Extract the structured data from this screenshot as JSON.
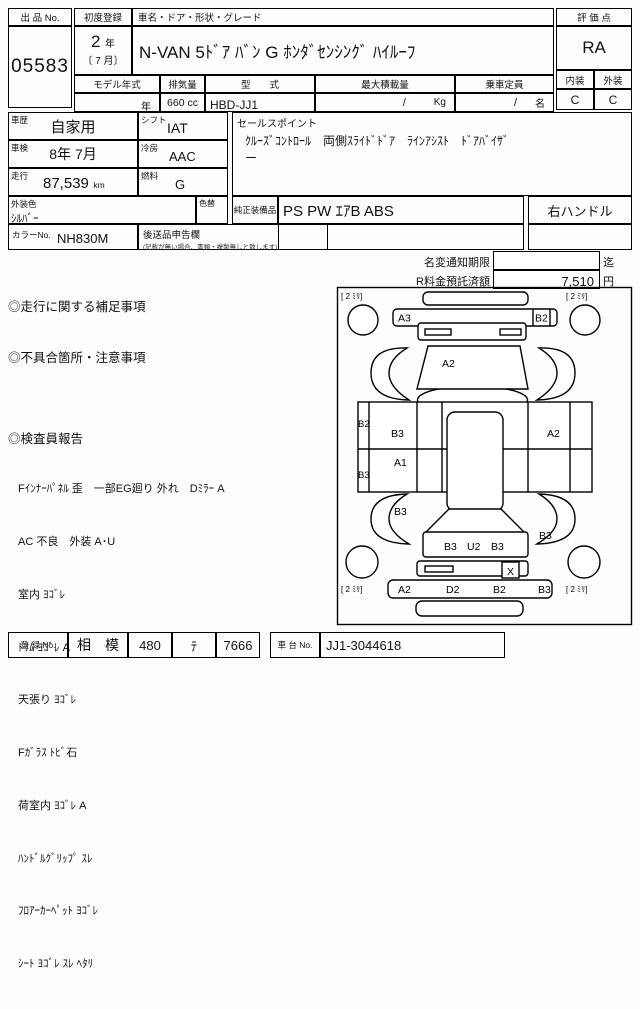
{
  "header": {
    "lot_label": "出 品 No.",
    "lot_no": "05583",
    "first_reg_label": "初度登録",
    "first_reg_year_num": "2",
    "first_reg_year_unit": "年",
    "first_reg_month": "〔 7 月〕",
    "car_name_label": "車名・ドア・形状・グレード",
    "car_name": "N-VAN 5ﾄﾞｱ ﾊﾞﾝ G ﾎﾝﾀﾞｾﾝｼﾝｸﾞ ﾊｲﾙｰﾌ",
    "score_label": "評 価 点",
    "score": "RA",
    "interior_label": "内装",
    "exterior_label": "外装",
    "interior_grade": "C",
    "exterior_grade": "C",
    "model_year_label": "モデル年式",
    "model_year": "年",
    "displacement_label": "排気量",
    "displacement": "660 cc",
    "model_code_label": "型　　式",
    "model_code": "HBD-JJ1",
    "max_load_label": "最大積載量",
    "max_load": "/",
    "max_load_unit": "Kg",
    "capacity_label": "乗車定員",
    "capacity": "/",
    "capacity_unit": "名"
  },
  "details": {
    "history_label": "車歴",
    "history": "自家用",
    "shift_label": "シフト",
    "shift": "IAT",
    "inspection_label": "車検",
    "inspection": "8年 7月",
    "ac_label": "冷房",
    "ac": "AAC",
    "mileage_label": "走行",
    "mileage": "87,539",
    "mileage_unit": "km",
    "fuel_label": "燃料",
    "fuel": "G",
    "ext_color_label": "外装色",
    "ext_color": "ｼﾙﾊﾞｰ",
    "color_change_label": "色替",
    "color_no_label": "カラーNo.",
    "color_no": "NH830M",
    "later_items_label": "後送品申告欄",
    "later_items_note": "(記載が無い場合、書類・複製無しと致します)",
    "sales_point_label": "セールスポイント",
    "sales_point_line1": "ｸﾙｰｽﾞｺﾝﾄﾛｰﾙ　両側ｽﾗｲﾄﾞﾄﾞｱ　ﾗｲﾝｱｼｽﾄ　ﾄﾞｱﾊﾞｲｻﾞ",
    "sales_point_line2": "ー",
    "equipment_label": "純正装備品",
    "equipment": "PS PW ｴｱB ABS",
    "handle": "右ハンドル"
  },
  "notice": {
    "name_change_label": "名変通知期限",
    "name_change_value": "",
    "name_change_unit": "迄",
    "recycle_label": "R料金預託済額",
    "recycle_value": "7,510",
    "recycle_unit": "円"
  },
  "remarks": {
    "mileage_notes_title": "◎走行に関する補足事項",
    "defects_title": "◎不具合箇所・注意事項",
    "inspector_title": "◎検査員報告",
    "inspector_lines": [
      "Fｲﾝﾅｰﾊﾟﾈﾙ 歪　一部EG廻り 外れ　Dﾐﾗｰ A",
      "AC 不良　外装 A･U",
      "室内 ﾖｺﾞﾚ",
      "ﾄﾘﾑ ﾖｺﾞﾚ A",
      "天張り ﾖｺﾞﾚ",
      "Fｶﾞﾗｽ ﾄﾋﾞ石",
      "荷室内 ﾖｺﾞﾚ A",
      "ﾊﾝﾄﾞﾙｸﾞﾘｯﾌﾟ ｽﾚ",
      "ﾌﾛｱｰｶｰﾍﾟｯﾄ ﾖｺﾞﾚ",
      "ｼｰﾄ ﾖｺﾞﾚ ｽﾚ ﾍﾀﾘ"
    ]
  },
  "diagram": {
    "corner_mark": "[ 2 ﾐﾘ]",
    "codes": {
      "front_bumper_left": "A3",
      "front_bumper_right": "B2",
      "windshield": "A2",
      "left_sill_front": "B2",
      "left_sill_rear": "B3",
      "left_door": "B3",
      "left_door_lower": "A1",
      "right_side": "A2",
      "left_rear_quarter": "B3",
      "right_rear_quarter": "B3",
      "rear_panel_left": "B3",
      "rear_panel_center": "U2",
      "rear_panel_right": "B3",
      "tail_x": "X",
      "rear_bumper_1": "A2",
      "rear_bumper_2": "D2",
      "rear_bumper_3": "B2",
      "rear_bumper_4": "B3"
    }
  },
  "footer": {
    "reg_label": "登 録 No.",
    "reg_area": "相　模",
    "reg_class": "480",
    "reg_kana": "ﾃ",
    "reg_number": "7666",
    "chassis_label": "車 台 No.",
    "chassis_no": "JJ1-3044618"
  }
}
